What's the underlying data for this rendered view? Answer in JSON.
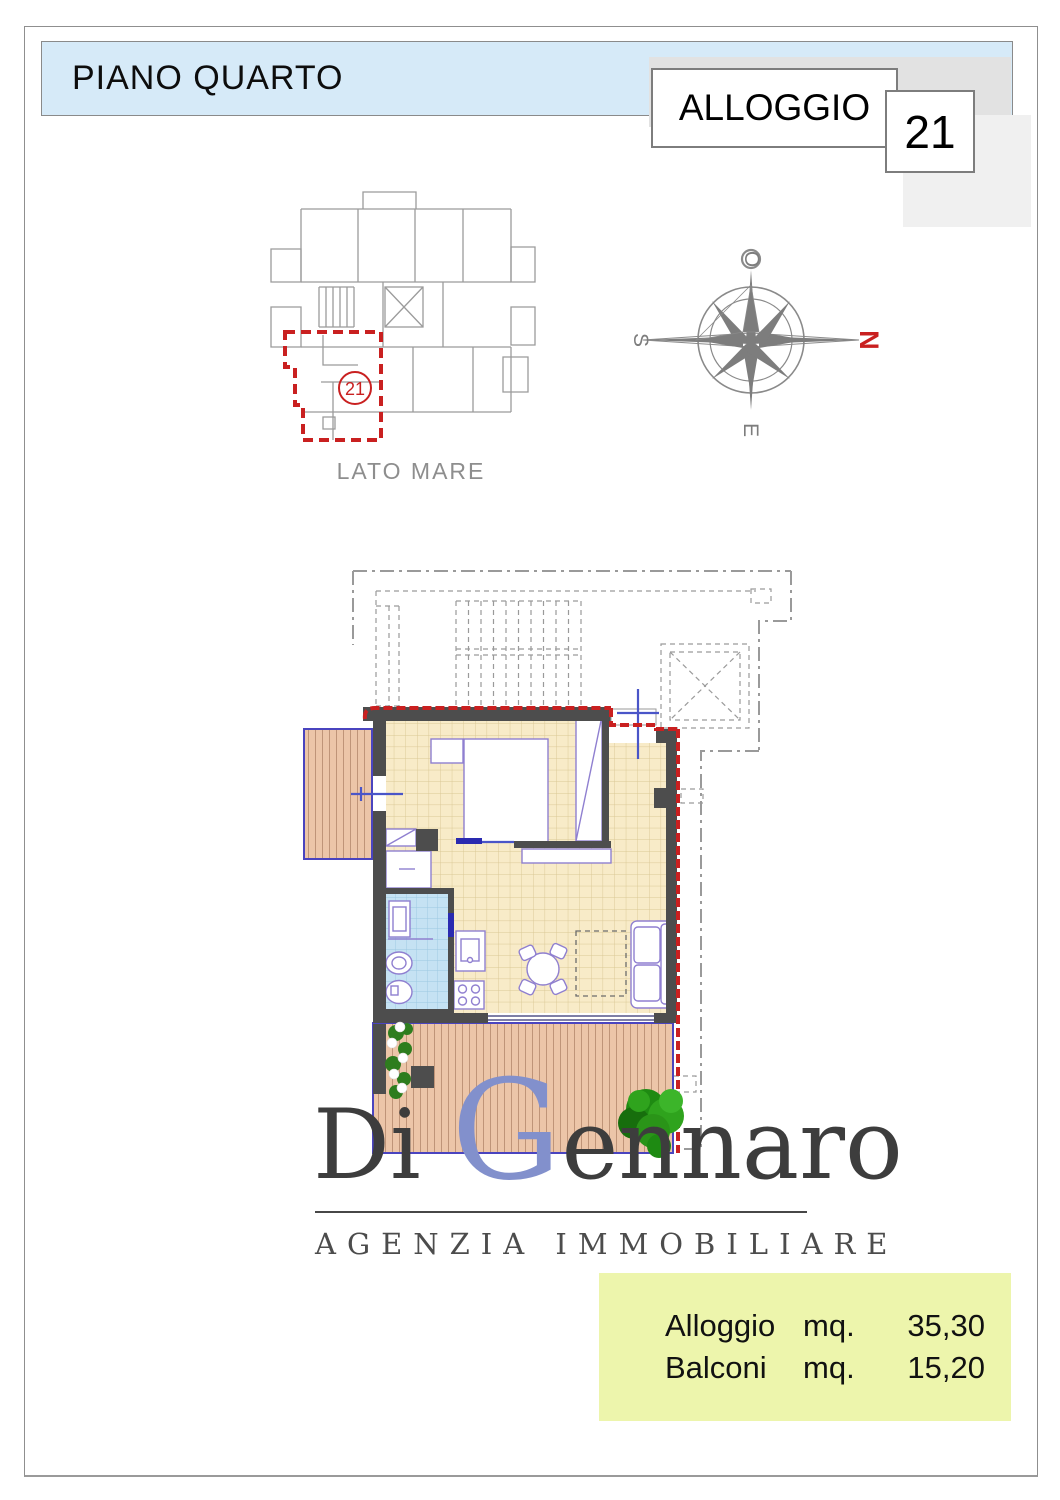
{
  "header": {
    "title": "PIANO QUARTO"
  },
  "unit": {
    "label": "ALLOGGIO",
    "number": "21"
  },
  "key_plan": {
    "unit_number": "21",
    "caption": "LATO  MARE"
  },
  "compass": {
    "west": "O",
    "south": "S",
    "north": "N",
    "east": "E"
  },
  "logo": {
    "name_di": "Di",
    "name_g": "G",
    "name_rest": "ennaro",
    "subtitle": "AGENZIA  IMMOBILIARE"
  },
  "summary": {
    "rows": [
      {
        "label": "Alloggio",
        "unit": "mq.",
        "value": "35,30"
      },
      {
        "label": "Balconi",
        "unit": "mq.",
        "value": "15,20"
      }
    ]
  },
  "colors": {
    "header_blue": "#d6eaf8",
    "boundary_red": "#c92020",
    "summary_yellow": "#edf5ac",
    "tile_beige": "#f8ebc8",
    "bath_blue": "#c5e2f3",
    "wood_salmon": "#ecc5a8",
    "balcony_border_blue": "#4a44bf",
    "wall_gray": "#4d4d4d",
    "furniture_purple": "#8f7fd0",
    "logo_blue": "#8290cc",
    "plan_gray": "#9a9a9a"
  }
}
